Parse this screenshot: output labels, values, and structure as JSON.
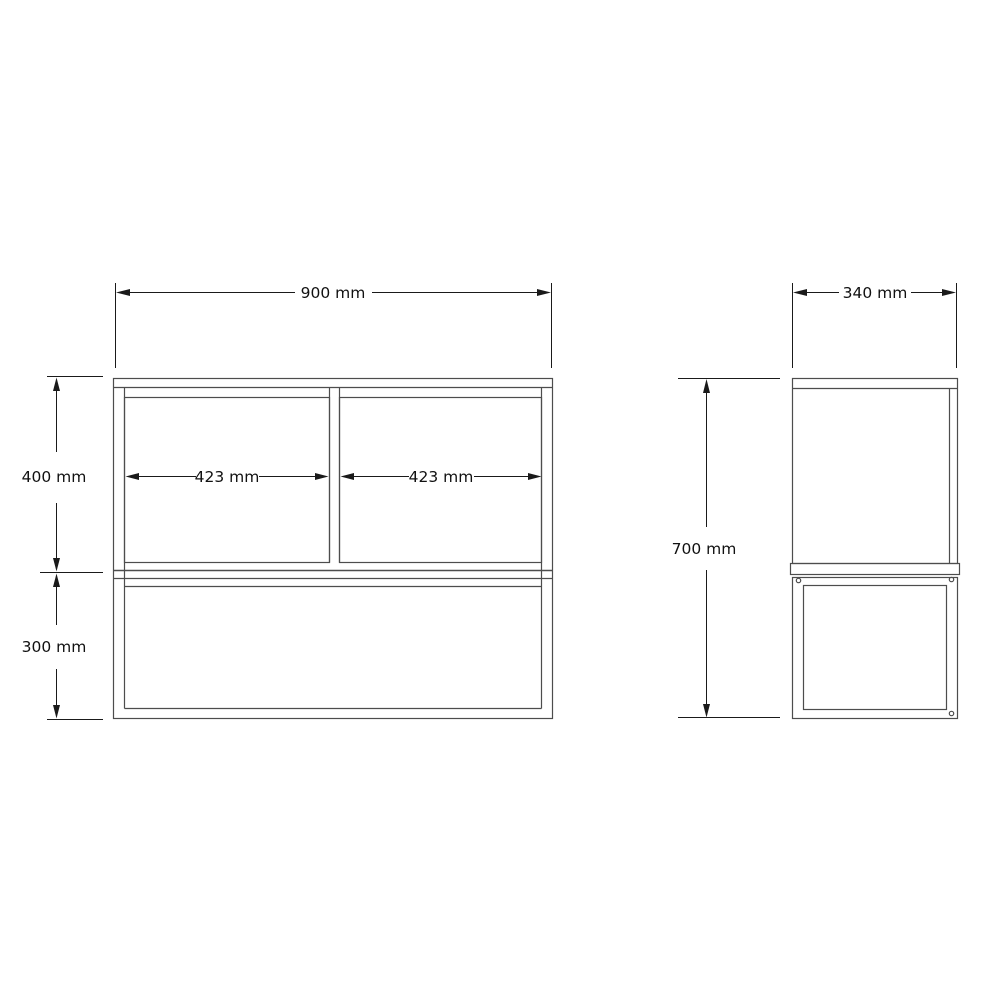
{
  "drawing": {
    "front": {
      "overall_width": "900 mm",
      "upper_height": "400 mm",
      "lower_height": "300 mm",
      "left_compartment": "423 mm",
      "right_compartment": "423 mm"
    },
    "side": {
      "depth": "340 mm",
      "height": "700 mm"
    },
    "colors": {
      "object_line": "#4d4d4d",
      "dimension_line": "#1a1a1a",
      "text": "#111111",
      "background": "#ffffff"
    }
  }
}
